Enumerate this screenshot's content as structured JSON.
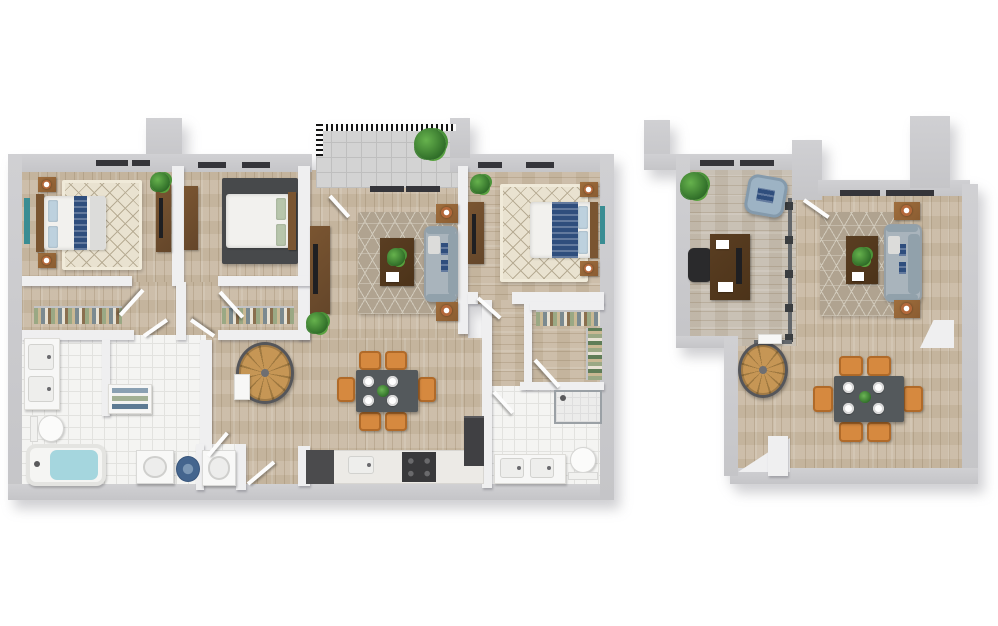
{
  "scene": {
    "kind": "3d-floor-plan-top-down-render",
    "background": "#ffffff",
    "plans": [
      {
        "id": "main-level",
        "rooms": [
          "bedroom-1",
          "closet-1",
          "bedroom-2",
          "closet-2",
          "bathroom-1",
          "laundry",
          "hall",
          "living-room",
          "balcony",
          "dining-area",
          "kitchen",
          "spiral-stair",
          "bedroom-3",
          "walk-in-closet",
          "bathroom-2"
        ],
        "furniture": [
          "queen-bed",
          "nightstands",
          "table-lamps",
          "dressers",
          "tv-consoles",
          "area-rugs",
          "sofa",
          "coffee-table",
          "side-tables",
          "dining-table-6-chairs",
          "plates",
          "plants",
          "double-vanity",
          "toilet",
          "bathtub",
          "towel-shelf",
          "washer",
          "dryer",
          "laundry-basket",
          "range",
          "fridge",
          "kitchen-sink",
          "shower",
          "spiral-staircase",
          "hanging-clothes"
        ]
      },
      {
        "id": "loft-level",
        "rooms": [
          "office-loft",
          "living-room",
          "dining-area",
          "spiral-stair",
          "stair-landing"
        ],
        "furniture": [
          "desk",
          "monitor",
          "office-chair",
          "blue-armchair",
          "plant",
          "sofa",
          "coffee-table",
          "side-tables",
          "table-lamps",
          "dining-table-6-chairs",
          "plates",
          "glass-railing",
          "spiral-staircase"
        ]
      }
    ]
  },
  "palette": {
    "wall": "#d0d0d3",
    "wallFace": "#efeff0",
    "floorWood": "#cabba5",
    "floorOffice": "#c6beb1",
    "tile": "#f4f4f2",
    "tileLine": "#e2e2df",
    "paver": "#d3d3d3",
    "paverLine": "#bfbfbf",
    "rugCream": "#e9e2d0",
    "rugCreamLine": "#b7ac94",
    "rugTaupe": "#b0a390",
    "rugTaupeLine": "#d1cabb",
    "rugDark": "#47494b",
    "sofa": "#a9b4bc",
    "sofaDark": "#91a1ab",
    "navy": "#2f4e7d",
    "lightBlue": "#bdd1de",
    "sage": "#b7c5ab",
    "orange": "#d6893f",
    "tableDark": "#54595c",
    "walnut": "#7a5531",
    "walnutDark": "#5a3e22",
    "nightstand": "#a06f3e",
    "copper": "#b4683a",
    "plantDark": "#2f6d28",
    "teal": "#3a8d93",
    "water": "#a5d6de",
    "applianceBlue": "#44658e",
    "marble": "#eceae6",
    "stairWood": "#c69655",
    "stairWoodDark": "#9e7840",
    "railDark": "#55565a",
    "glass": "#63676b"
  }
}
